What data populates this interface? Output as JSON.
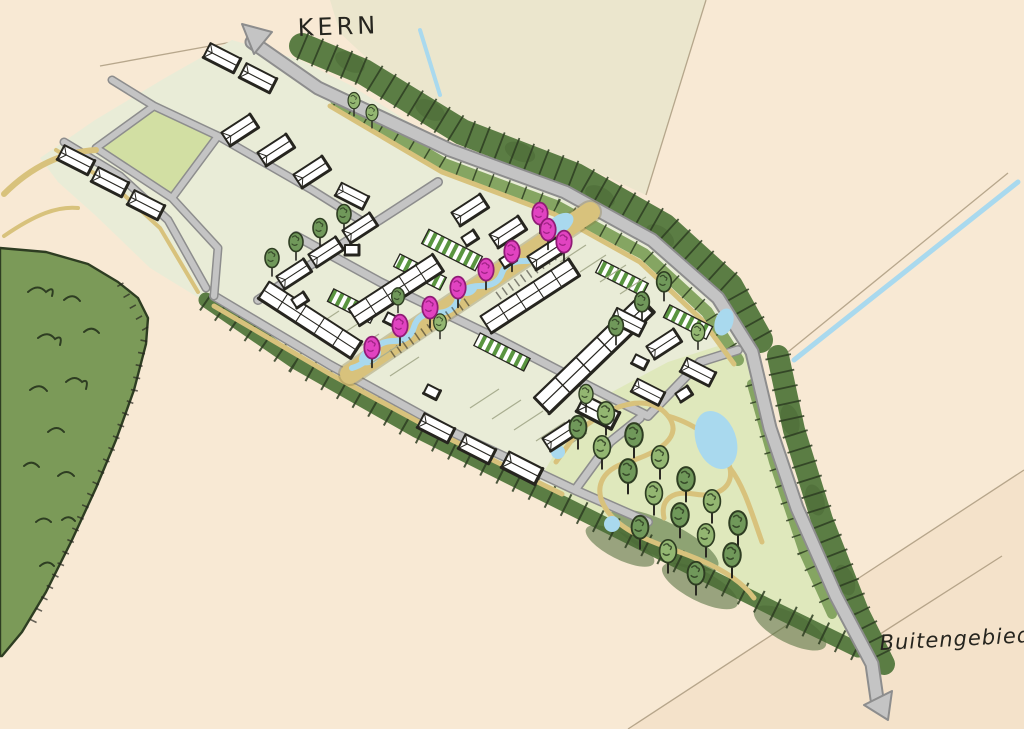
{
  "labels": {
    "kern": "KERN",
    "buitengebied": "Buitengebied"
  },
  "colors": {
    "paper": "#f8e9d4",
    "paper2": "#ebe6cd",
    "paper3": "#f4e2ca",
    "fieldline": "#9b8a6e",
    "water": "#a9d9ee",
    "forest": "#7b9a58",
    "inkgreen": "#2e3d22",
    "block": "#e9ecd7",
    "lawn": "#dfe8bc",
    "fieldgreen": "#d2dfa3",
    "band": "#5b7d44",
    "band2": "#85a562",
    "banddark": "#4a6a36",
    "road": "#c4c4c4",
    "roadedge": "#8d8d8d",
    "path": "#d8c27c",
    "pathedge": "#8a7a42",
    "pink": "#e143c1",
    "pinkdark": "#8f1b75",
    "tree": "#70985a",
    "treelight": "#93b671",
    "stripe": "#5a9540",
    "hatchline": "#a9ae90",
    "ink": "#26251f",
    "house": "#ffffff"
  }
}
